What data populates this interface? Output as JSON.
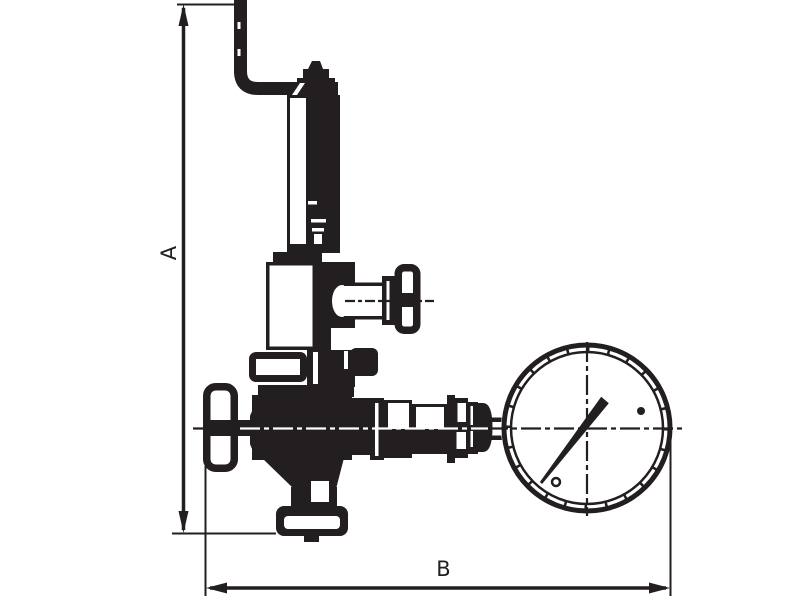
{
  "page": {
    "background_color": "#ffffff",
    "ink_color": "#231f20"
  },
  "diagram": {
    "type": "technical-drawing",
    "subject": "Pressure reducing valve with pressure gauge, dimensional outline drawing",
    "dimensions": [
      {
        "label": "A",
        "orientation": "vertical",
        "measures": "overall height from top of inlet pipe to bottom of outlet flange"
      },
      {
        "label": "B",
        "orientation": "horizontal",
        "measures": "overall width from inlet handwheel to right edge of pressure gauge"
      }
    ],
    "parts": [
      "inlet-elbow-pipe",
      "adjusting-screw",
      "spring-bonnet",
      "spring-housing",
      "side-valve-handwheel",
      "inlet-handwheel",
      "valve-body",
      "bottom-outlet-flange",
      "union-fitting",
      "connecting-pipe",
      "pressure-gauge",
      "gauge-needle"
    ]
  }
}
